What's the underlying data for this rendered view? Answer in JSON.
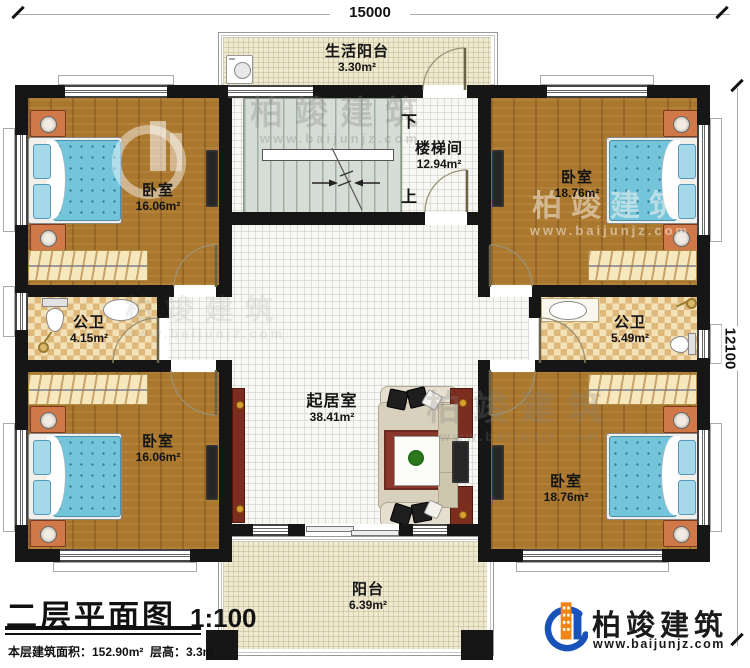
{
  "dimensions": {
    "top": "15000",
    "right": "12100"
  },
  "rooms": {
    "life_balcony": {
      "name": "生活阳台",
      "area": "3.30m²"
    },
    "stairwell": {
      "name": "楼梯间",
      "area": "12.94m²",
      "down_label": "下",
      "up_label": "上"
    },
    "bedroom_top_left": {
      "name": "卧室",
      "area": "16.06m²"
    },
    "bedroom_top_right": {
      "name": "卧室",
      "area": "18.76m²"
    },
    "bath_left": {
      "name": "公卫",
      "area": "4.15m²"
    },
    "bath_right": {
      "name": "公卫",
      "area": "5.49m²"
    },
    "living_room": {
      "name": "起居室",
      "area": "38.41m²"
    },
    "bedroom_bottom_left": {
      "name": "卧室",
      "area": "16.06m²"
    },
    "bedroom_bottom_right": {
      "name": "卧室",
      "area": "18.76m²"
    },
    "balcony": {
      "name": "阳台",
      "area": "6.39m²"
    }
  },
  "title_block": {
    "title": "二层平面图",
    "scale": "1:100",
    "floor_area": "本层建筑面积：152.90m²",
    "floor_height": "层高：3.3m"
  },
  "brand": {
    "name": "柏竣建筑",
    "url": "www.baijunjz.com"
  },
  "watermark": {
    "name": "柏竣建筑",
    "url": "www.baijunjz.com"
  },
  "colors": {
    "wall": "#161616",
    "wood_floor": "#a9772e",
    "bath_tile": "#dfb87c",
    "mattress": "#74c4da",
    "rug": "#8a372c",
    "tv_cabinet": "#7c2d1f",
    "brand_blue": "#1753b8",
    "brand_orange": "#f08418"
  }
}
